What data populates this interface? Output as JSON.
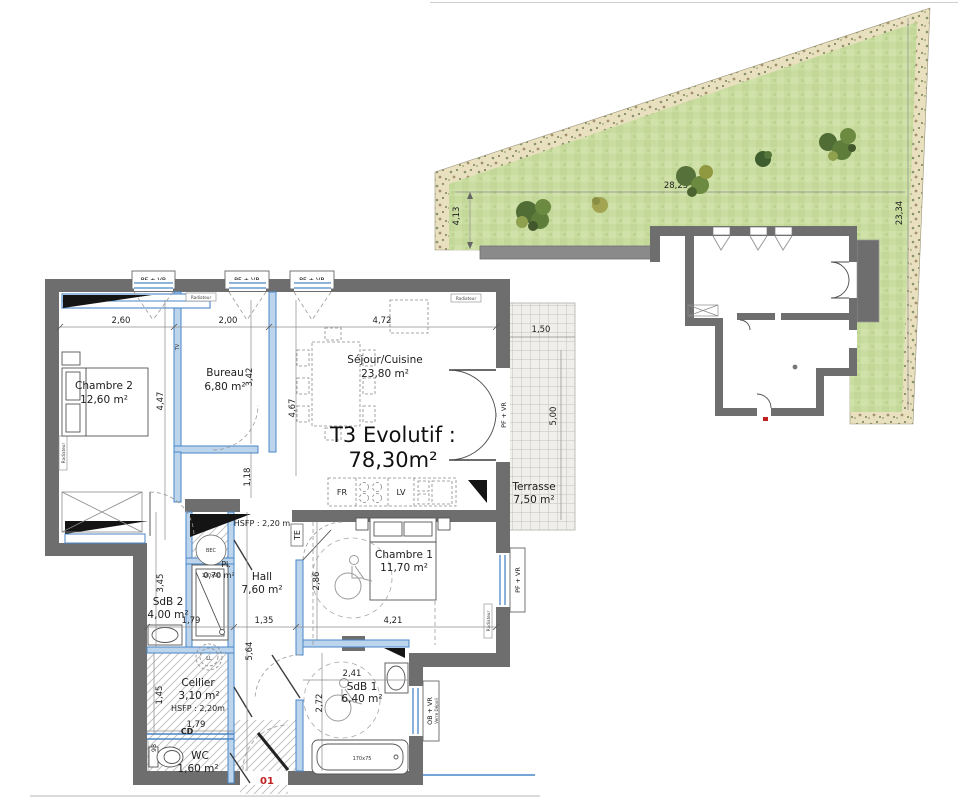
{
  "plan": {
    "title_line1": "T3 Evolutif :",
    "title_line2": "78,30m²",
    "door_number": "01"
  },
  "rooms": {
    "chambre2": {
      "name": "Chambre 2",
      "area": "12,60 m²"
    },
    "bureau": {
      "name": "Bureau",
      "area": "6,80 m²"
    },
    "sejour": {
      "name": "Séjour/Cuisine",
      "area": "23,80 m²"
    },
    "chambre1": {
      "name": "Chambre 1",
      "area": "11,70 m²"
    },
    "hall": {
      "name": "Hall",
      "area": "7,60 m²"
    },
    "sdb2": {
      "name": "SdB 2",
      "area": "4,00 m²"
    },
    "placard": {
      "name": "Pl.",
      "area": "0,70 m²"
    },
    "cellier": {
      "name": "Cellier",
      "area": "3,10 m²"
    },
    "wc": {
      "name": "WC",
      "area": "1,60 m²"
    },
    "sdb1": {
      "name": "SdB 1",
      "area": "6,40 m²"
    },
    "terrasse": {
      "name": "Terrasse",
      "area": "7,50 m²"
    }
  },
  "dimensions": {
    "top_chambre2": "2,60",
    "top_bureau": "2,00",
    "top_sejour": "4,72",
    "chambre2_height": "4,47",
    "bureau_height": "3,42",
    "sejour_height": "4,67",
    "below_bureau": "1,18",
    "terrasse_width": "1,50",
    "terrasse_height": "5,00",
    "sdb2_height": "3,45",
    "sdb2_width": "1,79",
    "hall_width": "1,35",
    "chambre1_width": "4,21",
    "hall_height": "5,64",
    "chambre1_height": "2,86",
    "sdb1_width": "2,41",
    "sdb1_height": "2,72",
    "cellier_height": "1,45",
    "cellier_width": "1,79",
    "wc_width": "93",
    "garden_width": "28,25",
    "garden_left": "4,13",
    "garden_right": "23,34"
  },
  "openings": {
    "window_pf_vr": "PF + VR",
    "window_ob_vr": "OB + VR",
    "window_glass": "Verre Dépoli",
    "radiator": "Radiateur"
  },
  "annotations": {
    "hsfp_hall": "HSFP : 2,20 m",
    "hsfp_cellier": "HSFP : 2,20m",
    "cd": "CD",
    "te": "TE",
    "tv": "TV",
    "fridge": "FR",
    "dishwasher": "LV",
    "water_heater": "BEC",
    "washing_machine": "LL",
    "shower_size": "120x90",
    "bathtub_size": "170x75"
  },
  "colors": {
    "wall": "#6e6e6e",
    "partition_fill": "#bdd5ec",
    "partition_edge": "#4a86c8",
    "garden_green": "#c9dda0",
    "garden_border": "#e9e0c0",
    "accent_red": "#c22020"
  }
}
